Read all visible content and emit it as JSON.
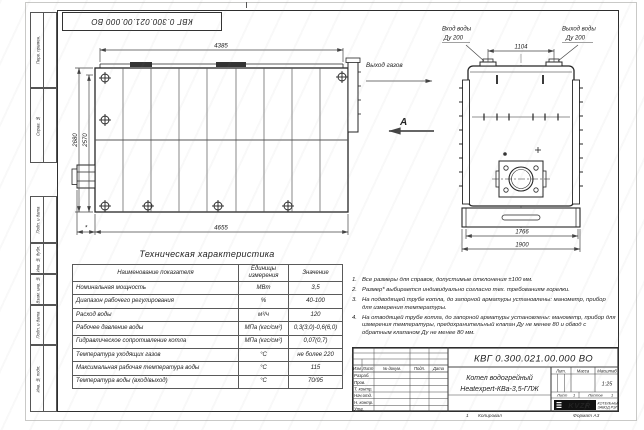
{
  "sheet": {
    "corner_stamp": "КВГ 0.300.021.00.000 ВО",
    "side_stamps": [
      "Перв. примен.",
      "Справ. №",
      "Подп. и дата",
      "Инв. № дубл.",
      "Взам. инв. №",
      "Подп. и дата",
      "Инв. № подл."
    ],
    "footer": {
      "zone": "1",
      "copied": "Копировал",
      "format": "Формат А3"
    }
  },
  "side_view": {
    "dim_top": "4385",
    "dim_bottom": "4655",
    "dim_height_outer": "2680",
    "dim_height_inner": "2570",
    "dim_burner": "*",
    "gas_label": "Выход газов",
    "view_label": "А"
  },
  "front_view": {
    "inlet_line1": "Вход воды",
    "inlet_line2": "Ду 200",
    "outlet_line1": "Выход воды",
    "outlet_line2": "Ду 200",
    "dim_flanges": "1104",
    "dim_body": "1766",
    "dim_base": "1900"
  },
  "spec_table": {
    "title": "Техническая характеристика",
    "headers": [
      "Наименование показателя",
      "Единицы измерения",
      "Значение"
    ],
    "rows": [
      [
        "Номинальная мощность",
        "МВт",
        "3,5"
      ],
      [
        "Диапазон рабочего регулирования",
        "%",
        "40-100"
      ],
      [
        "Расход воды",
        "м³/ч",
        "120"
      ],
      [
        "Рабочее давление воды",
        "МПа (кгс/см²)",
        "0,3(3,0)-0,6(6,0)"
      ],
      [
        "Гидравлическое сопротивление котла",
        "МПа (кгс/см²)",
        "0,07(0,7)"
      ],
      [
        "Температура уходящих газов",
        "°С",
        "не более 220"
      ],
      [
        "Максимальная рабочая температура воды",
        "°С",
        "115"
      ],
      [
        "Температура воды (вход/выход)",
        "°С",
        "70/95"
      ]
    ]
  },
  "notes": [
    {
      "num": "1.",
      "text": "Все размеры для справок, допустимые отклонения ±100 мм."
    },
    {
      "num": "2.",
      "text": "Размер* выбирается индивидуально согласно тех. требованиям горелки."
    },
    {
      "num": "3.",
      "text": "На подводящей трубе котла, до запорной арматуры установлены: манометр, прибор для измерения температуры."
    },
    {
      "num": "4.",
      "text": "На отводящей трубе котла, до запорной арматуры установлены: манометр, прибор для измерения температуры, предохранительный клапан Ду не менее 80 и обвод с обратным клапаном Ду не менее 80 мм."
    }
  ],
  "title_block": {
    "doc_number": "КВГ 0.300.021.00.000 ВО",
    "name_line1": "Котел водогрейный",
    "name_line2": "Heatexpert-КВа-3,5-ГЛЖ",
    "cols": [
      "Изм",
      "Лист",
      "№ докум.",
      "Подп.",
      "Дата"
    ],
    "staff": [
      "Разраб.",
      "Пров.",
      "Т. контр.",
      "Нач.отд.",
      "Н. контр.",
      "Утв."
    ],
    "lit_label": "Лит.",
    "mass_label": "Масса",
    "scale_label": "Масштаб",
    "scale_value": "1:25",
    "sheet_label": "Лист",
    "sheet_value": "1",
    "sheets_label": "Листов",
    "sheets_value": "1",
    "logo_text": "KVZR",
    "logo_caption1": "КОТЕЛЬНЫЙ",
    "logo_caption2": "ЗАВОД РЭП"
  }
}
